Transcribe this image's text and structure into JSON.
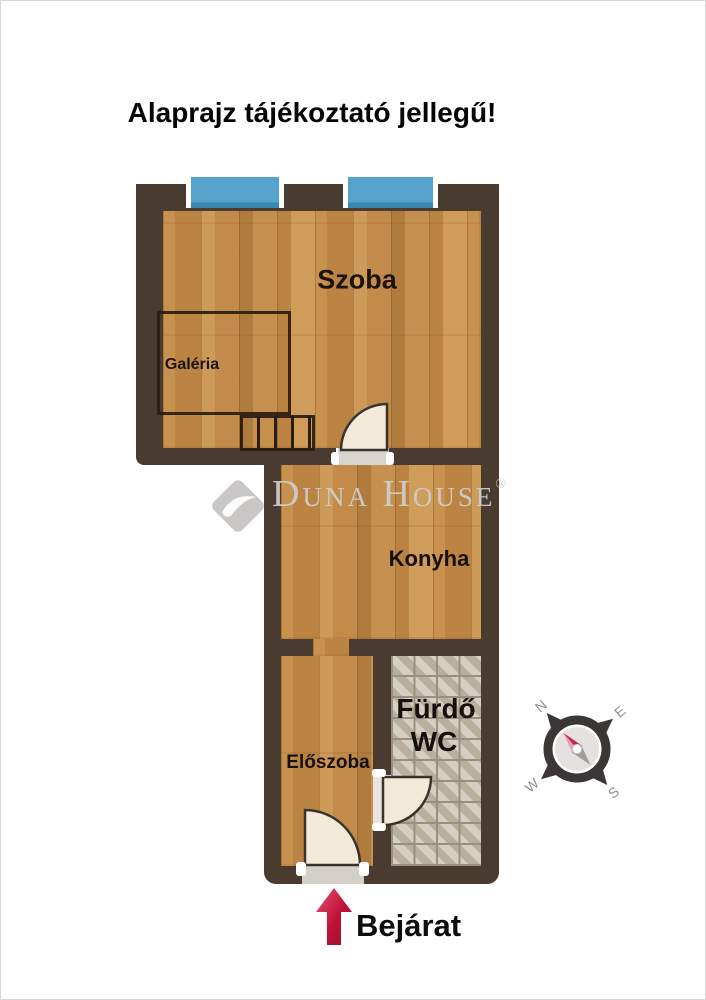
{
  "title": "Alaprajz tájékoztató jellegű!",
  "watermark": {
    "brand": "Duna House",
    "registered": "®"
  },
  "rooms": {
    "szoba": "Szoba",
    "galeria": "Galéria",
    "konyha": "Konyha",
    "furdo": "Fürdő",
    "wc": "WC",
    "eloszoba": "Előszoba"
  },
  "entrance": {
    "label": "Bejárat"
  },
  "compass": {
    "n": "N",
    "e": "E",
    "s": "S",
    "w": "W"
  },
  "colors": {
    "wall": "#4a3b31",
    "wood_floor": "#c28b4a",
    "window_glass": "#55a3cc",
    "tile_floor": "#c8bdad",
    "door_leaf": "#f2e9d8",
    "entrance_arrow_red": "#c81440",
    "watermark_gray": "#cecccb",
    "compass_needle_red": "#c22a4e"
  }
}
